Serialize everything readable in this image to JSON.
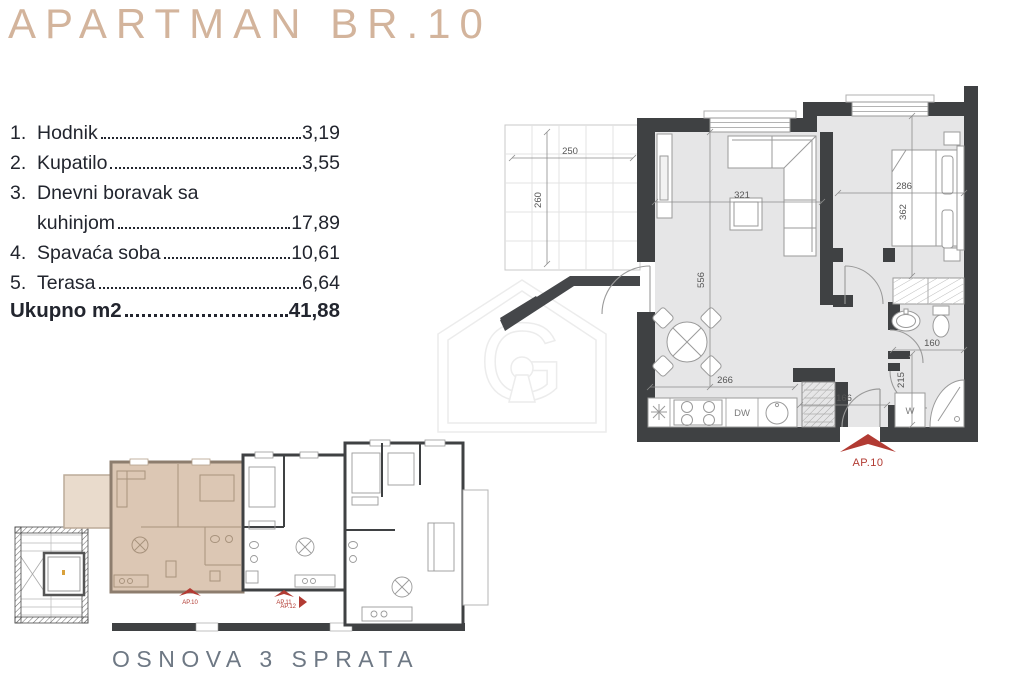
{
  "title": "APARTMAN BR.10",
  "room_list": {
    "rows": [
      {
        "num": "1.",
        "label": "Hodnik",
        "value": "3,19"
      },
      {
        "num": "2.",
        "label": "Kupatilo",
        "value": "3,55"
      },
      {
        "num": "3.",
        "label": "Dnevni boravak sa",
        "value": ""
      },
      {
        "num": "",
        "label": "kuhinjom",
        "value": "17,89"
      },
      {
        "num": "4.",
        "label": "Spavaća soba",
        "value": "10,61"
      },
      {
        "num": "5.",
        "label": "Terasa",
        "value": "6,64"
      }
    ],
    "total_label": "Ukupno m2",
    "total_value": "41,88"
  },
  "floor_plan": {
    "dimensions": {
      "terrace_width": "250",
      "terrace_height": "260",
      "living_width": "321",
      "living_height": "556",
      "bedroom_width": "286",
      "bedroom_height": "362",
      "kitchen_width": "266",
      "entry_width": "166",
      "bath_width": "160",
      "bath_height": "215"
    },
    "labels": {
      "dishwasher": "DW",
      "washing_machine": "W",
      "apartment_marker": "AP.10"
    }
  },
  "site_plan": {
    "markers": {
      "ap10": "AP.10",
      "ap11": "AP.11",
      "ap12": "AP.12"
    }
  },
  "watermark_letter": "G",
  "footer_caption": "OSNOVA 3 SPRATA",
  "colors": {
    "title_tan": "#d3b49c",
    "text_dark": "#22252e",
    "wall_dark": "#3f4143",
    "floor_gray": "#e6e6e7",
    "highlight_tan": "#dcc7b4",
    "terrace_tan": "#e9dbcc",
    "marker_red": "#b23b33",
    "caption_gray": "#6e7884"
  }
}
